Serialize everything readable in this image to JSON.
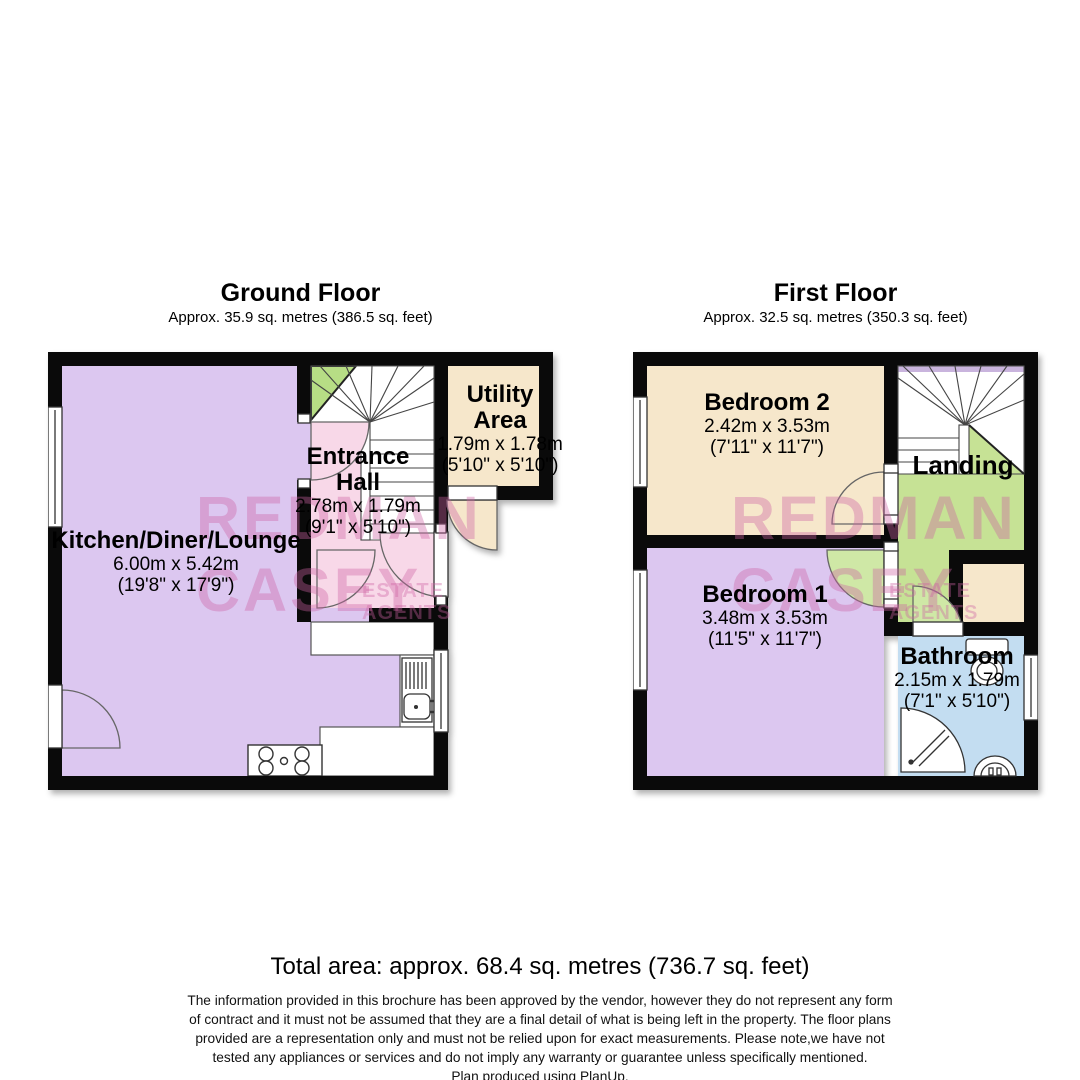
{
  "floors": [
    {
      "title": "Ground Floor",
      "subtitle": "Approx. 35.9 sq. metres (386.5 sq. feet)",
      "rooms": [
        {
          "name": "Kitchen/Diner/Lounge",
          "metric": "6.00m x 5.42m",
          "imperial": "(19'8\" x 17'9\")"
        },
        {
          "name": "Entrance Hall",
          "metric": "2.78m x 1.79m",
          "imperial": "(9'1\" x 5'10\")"
        },
        {
          "name": "Utility Area",
          "metric": "1.79m x 1.78m",
          "imperial": "(5'10\" x 5'10\")"
        }
      ]
    },
    {
      "title": "First Floor",
      "subtitle": "Approx. 32.5 sq. metres (350.3 sq. feet)",
      "rooms": [
        {
          "name": "Bedroom 2",
          "metric": "2.42m x 3.53m",
          "imperial": "(7'11\" x 11'7\")"
        },
        {
          "name": "Landing"
        },
        {
          "name": "Bedroom 1",
          "metric": "3.48m x 3.53m",
          "imperial": "(11'5\" x 11'7\")"
        },
        {
          "name": "Bathroom",
          "metric": "2.15m x 1.79m",
          "imperial": "(7'1\" x 5'10\")"
        }
      ]
    }
  ],
  "watermark": {
    "big": "REDMAN\nCASEY",
    "sub1": "ESTATE",
    "sub2": "AGENTS"
  },
  "footer": {
    "total": "Total area: approx. 68.4 sq. metres (736.7 sq. feet)",
    "disclaimer": [
      "The information provided in this brochure has been approved by the vendor, however they do not represent any form",
      "of contract and it must not be assumed that they are a final detail of what is being left in the property. The floor plans",
      "provided are a representation only and must not be relied upon for exact measurements. Please note,we have not",
      "tested any appliances or services and do not imply any warranty or guarantee unless specifically mentioned.",
      "Plan produced using PlanUp."
    ]
  },
  "colors": {
    "wall": "#0a0a0a",
    "kitchen_lounge": "#dcc7f0",
    "entrance_hall": "#f8d8e8",
    "utility_bedroom2": "#f6e7cb",
    "bedroom1": "#dcc7f0",
    "landing": "#c6e295",
    "bathroom": "#c3ddf1",
    "understairs_green": "#b7dd85",
    "watermark_pink": "#cd62a2"
  }
}
